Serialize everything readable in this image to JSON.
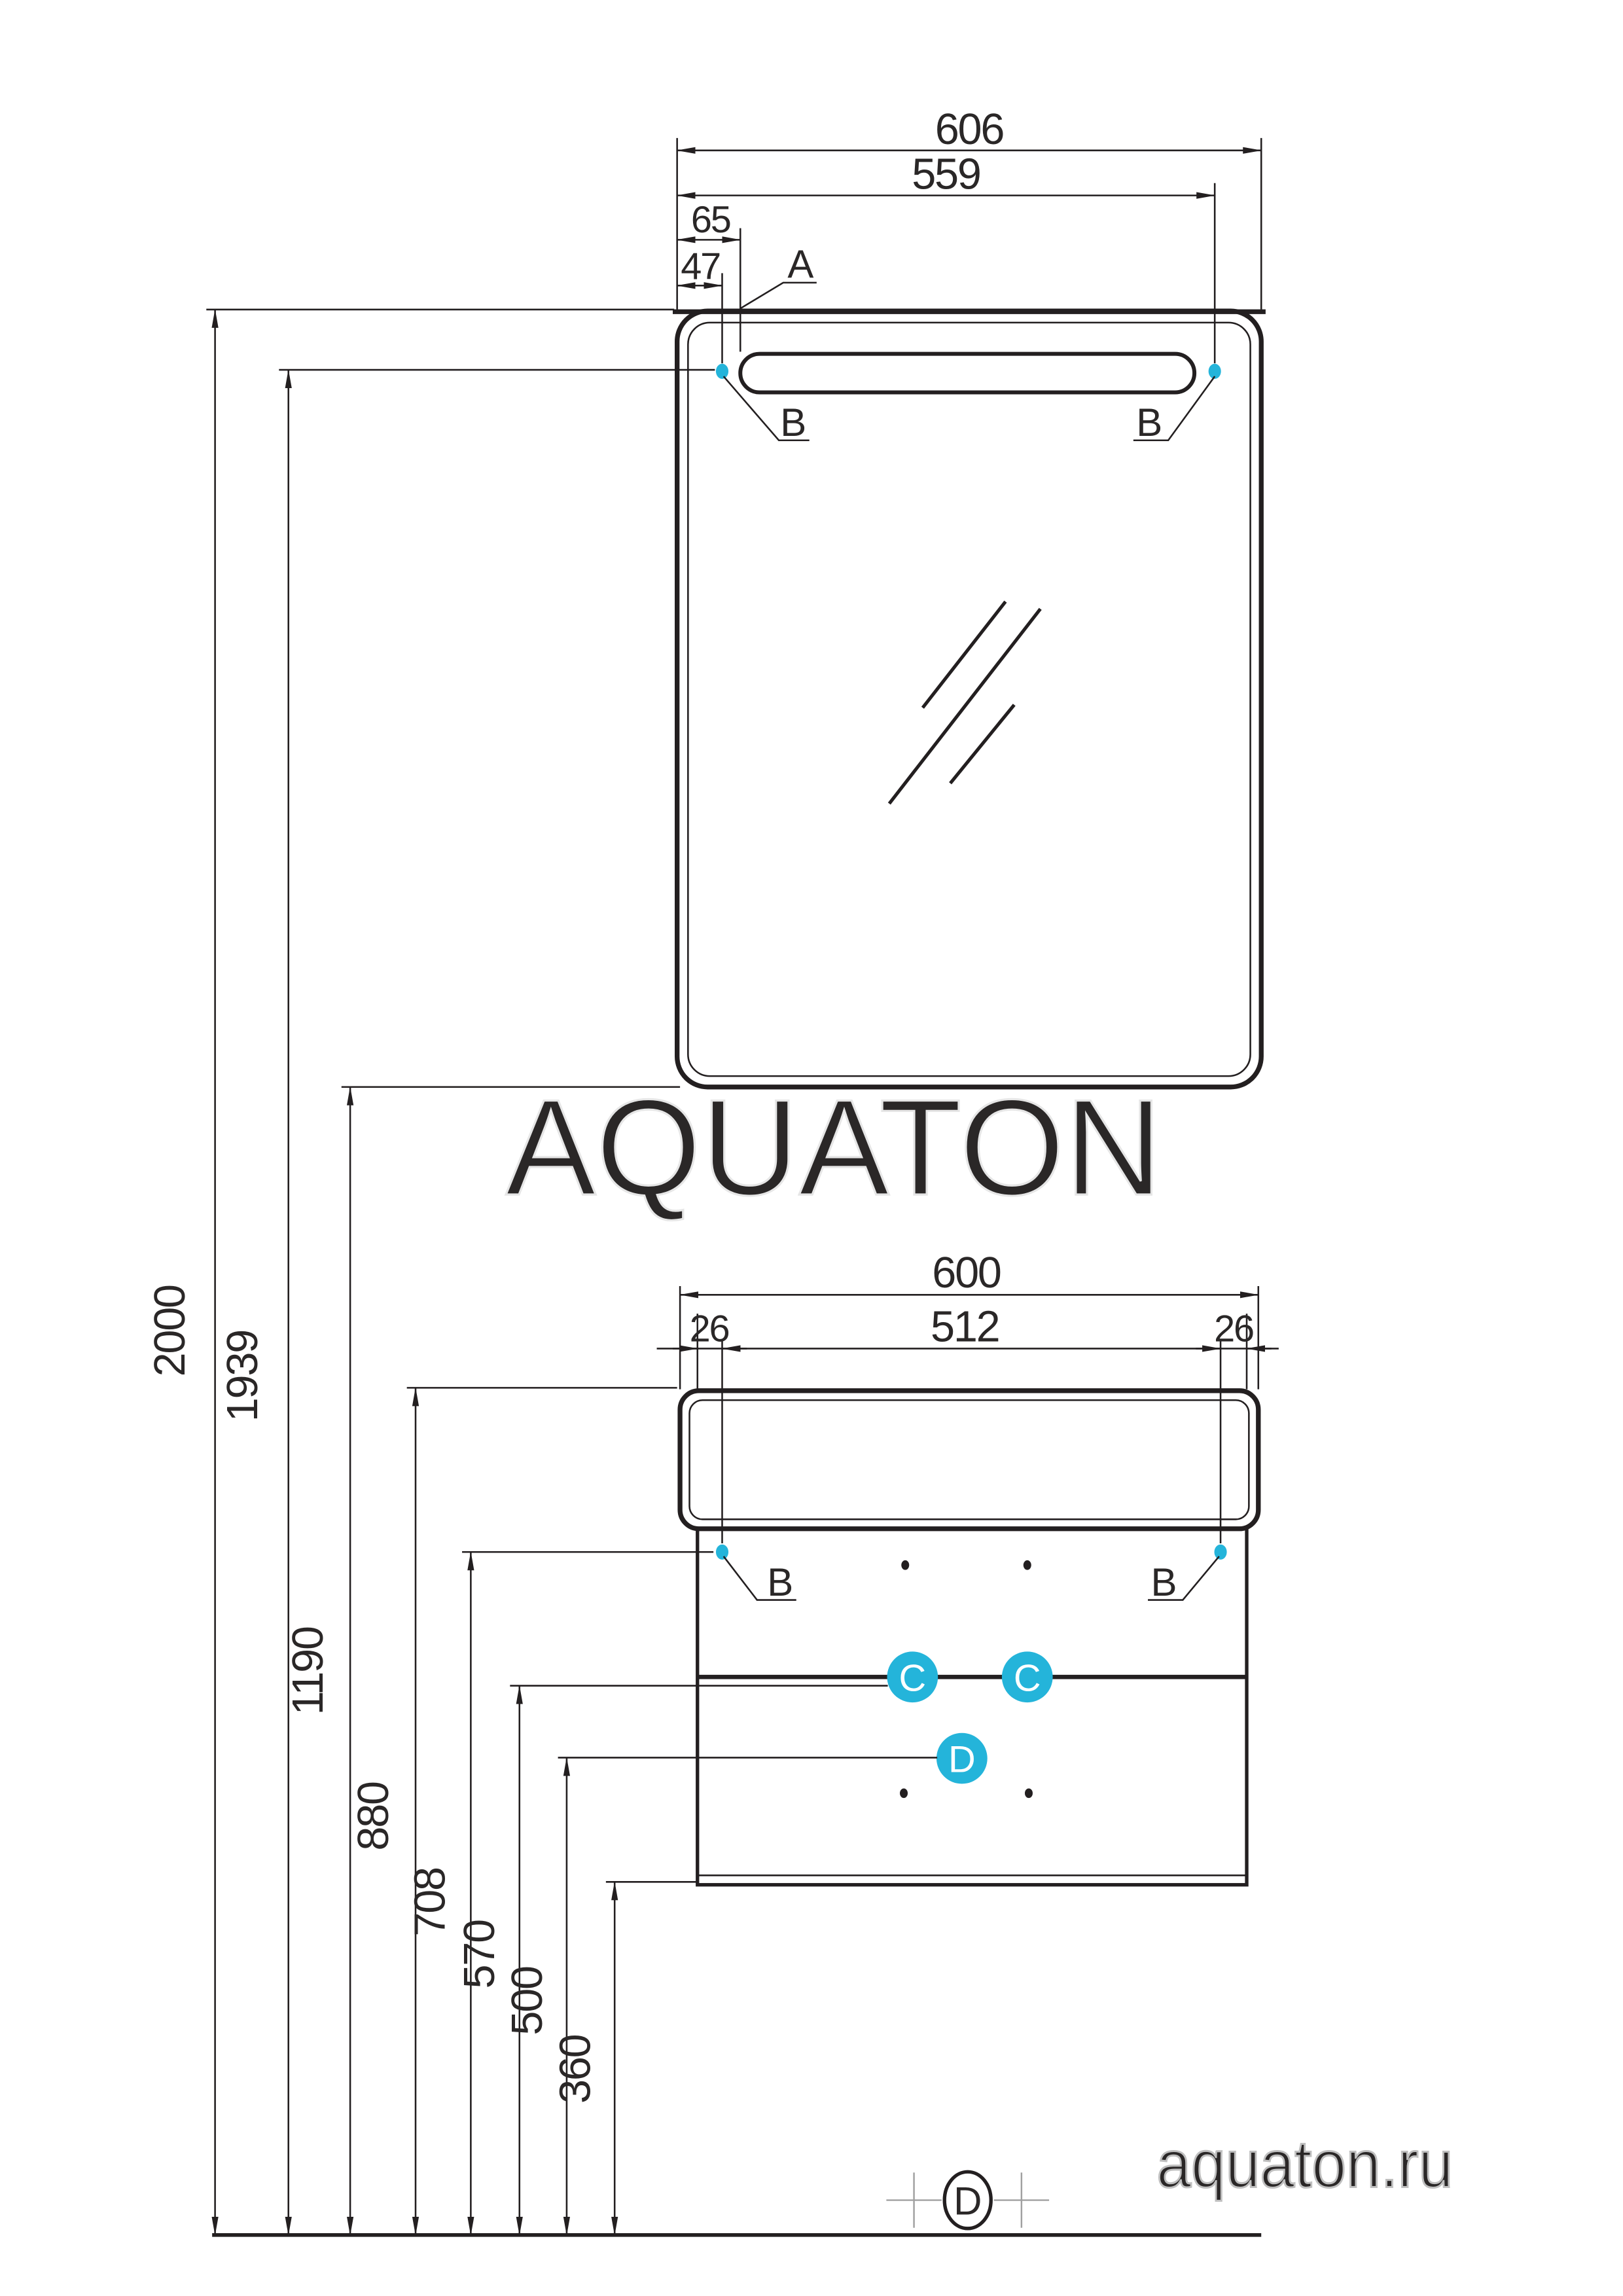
{
  "page": {
    "watermark": "AQUATON",
    "website": "aquaton.ru"
  },
  "colors": {
    "line": "#231f20",
    "accent": "#24b4da",
    "watermark_outline": "#e6e6e6",
    "website_outline": "#bfbfbf",
    "registration_cross": "#a0a0a0"
  },
  "mirror": {
    "dim_overall_width": "606",
    "dim_fixing_width": "559",
    "dim_lamp_offset": "65",
    "dim_fixing_offset": "47",
    "label_a": "A",
    "label_b_left": "B",
    "label_b_right": "B"
  },
  "cabinet": {
    "dim_overall_width": "600",
    "dim_fixing_width": "512",
    "dim_offset_left": "26",
    "dim_offset_right": "26",
    "label_b_left": "B",
    "label_b_right": "B",
    "label_c_left": "C",
    "label_c_right": "C",
    "label_d": "D"
  },
  "heights": {
    "total": "2000",
    "mirror_fixing": "1939",
    "mirror_bottom": "1190",
    "cabinet_top": "880",
    "cabinet_fixing": "708",
    "drawer_divider": "570",
    "lower_drawer": "500",
    "cabinet_bottom": "360"
  },
  "floor": {
    "label_d": "D"
  }
}
